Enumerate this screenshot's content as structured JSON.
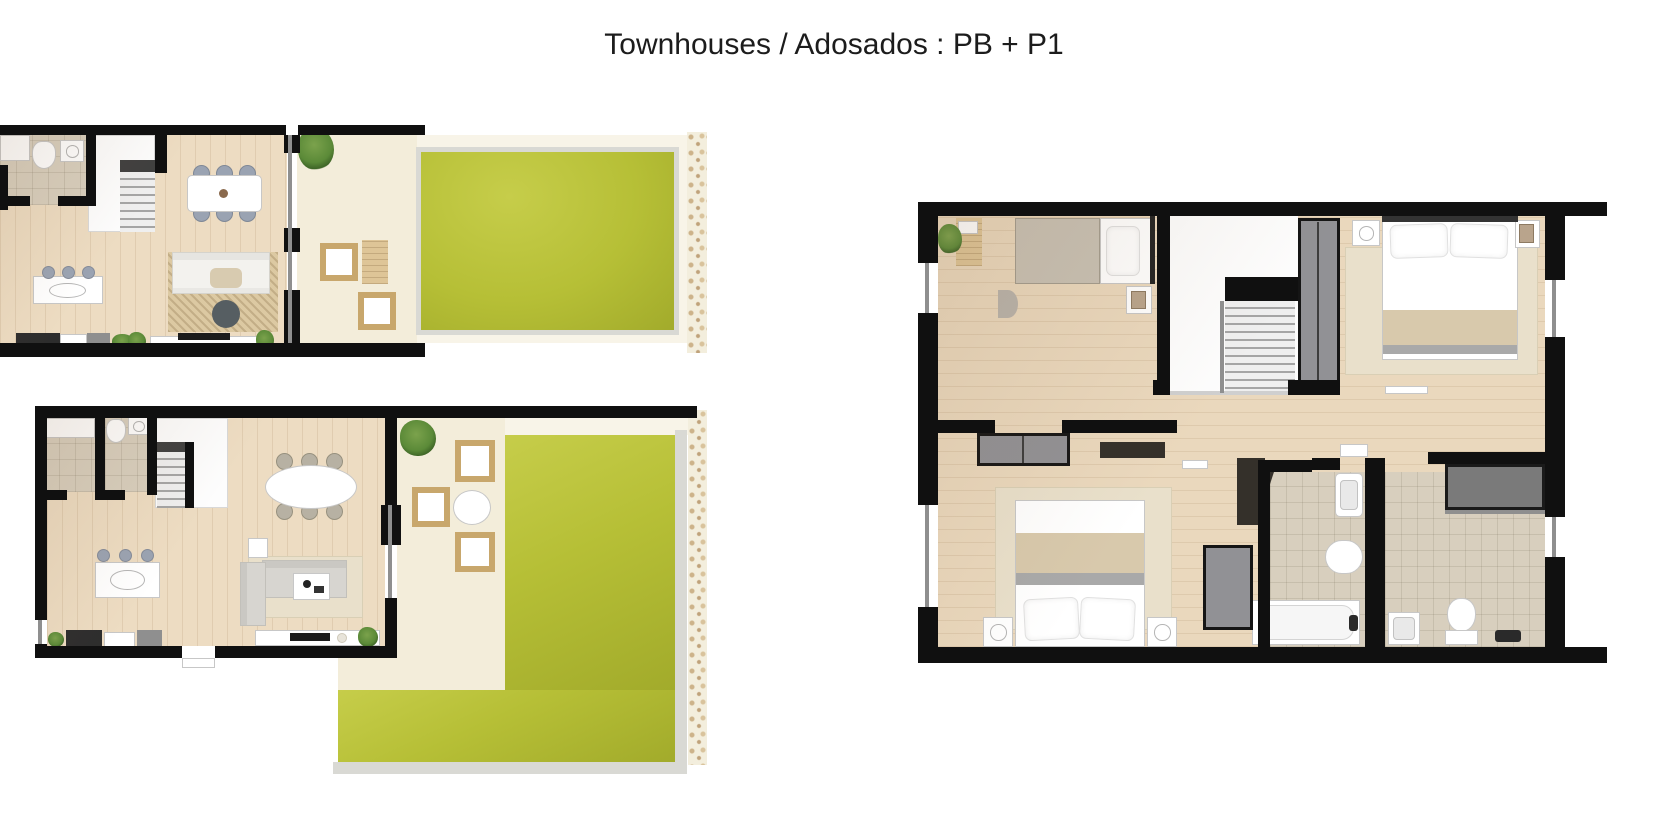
{
  "title": "Townhouses / Adosados : PB + P1",
  "plans": [
    {
      "id": "pb-partial",
      "role": "ground-floor-plan-left-partial"
    },
    {
      "id": "pb-full",
      "role": "ground-floor-plan-lower-left"
    },
    {
      "id": "p1",
      "role": "first-floor-plan-right"
    }
  ],
  "colors": {
    "background": "#ffffff",
    "title_text": "#1c1c1c",
    "wall": "#101010",
    "wood": "#eddcc2",
    "wood_upper": "#ead8bd",
    "tile": "#d8cfbe",
    "terrace": "#f3edda",
    "terrace_light": "#f8f4e8",
    "lawn": "#b6bf36",
    "lawn_light": "#c6cd4a",
    "lawn_dark": "#a2ab2b",
    "curb": "#d9d9d4",
    "gravel": "#f3eedd",
    "gravel_speck": "#cdb38a",
    "fixture_white": "#ffffff",
    "fixture_border": "#c7c7c7",
    "chair_gray": "#9aa3b2",
    "chair_beige": "#b7b1a3",
    "sofa": "#f3f2ee",
    "sofa_gray": "#d7d5d0",
    "rug": "#dcc9a2",
    "rug_light": "#e9e0cb",
    "wicker": "#c8a76c",
    "wood_furn": "#dec597",
    "dark_furn": "#34302a",
    "gray_unit": "#919195",
    "shower_gray": "#7a7a7a",
    "blanket_beige": "#d8c9ac",
    "blanket_gray": "#a9a9a9",
    "mattress_gray": "#c8c1b4",
    "plant_green": "#5b8a38",
    "pouf_dark": "#565e62",
    "glass": "#8f8f8f",
    "counter_dark": "#2d2d2d",
    "counter_gray": "#8f8f8f",
    "stair_tread": "#a5a5a5",
    "stair_dark": "#3f3f3f",
    "title_color": "#1c1c1c"
  }
}
